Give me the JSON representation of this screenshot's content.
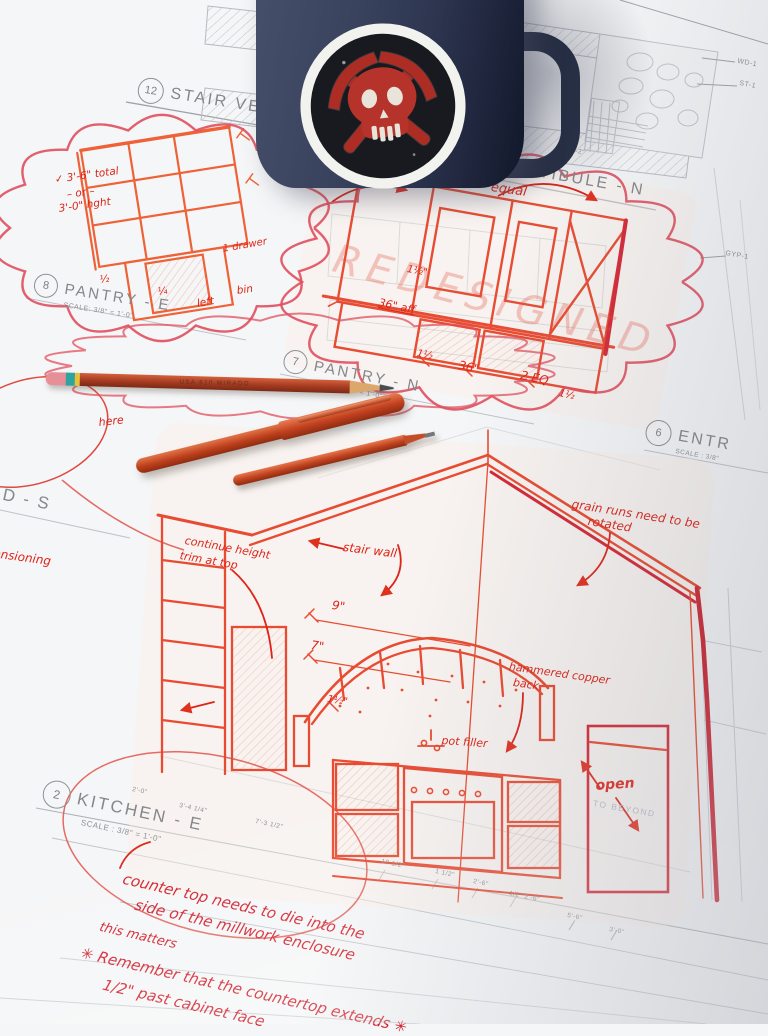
{
  "titles": {
    "v12": {
      "n": "12",
      "t": "STAIR VESTIBULE"
    },
    "v11": {
      "n": "11",
      "t": "STAIR VESTIBULE - N",
      "s": "SCALE:  3/8\" = 1'-0\""
    },
    "p8": {
      "n": "8",
      "t": "PANTRY - E",
      "s": "SCALE:  3/8\" = 1'-0\""
    },
    "p7": {
      "n": "7",
      "t": "PANTRY - N",
      "s": "SCALE:  3/8\" = 1'-0\""
    },
    "e6": {
      "n": "6",
      "t": "ENTR",
      "s": "SCALE : 3/8\""
    },
    "k2": {
      "n": "2",
      "t": "KITCHEN - E",
      "s": "SCALE : 3/8\" = 1'-0\""
    },
    "ds": {
      "t": "D - S"
    }
  },
  "plabels": {
    "wd1": "WD-1",
    "st1": "ST-1",
    "gyp1": "GYP-1",
    "beyond": "TO BEYOND",
    "d142": "14'-2\"",
    "dims": {
      "a": "2'-0\"",
      "b": "3'-4 1/4\"",
      "c": "7'-3 1/2\"",
      "d": "10 1/2\"",
      "e": "1 1/2\"",
      "f": "2'-6\"",
      "g": "1/2\" 2'-6\"",
      "h": "5'-6\"",
      "i": "3'-0\""
    }
  },
  "notes": {
    "equal": "equal",
    "redesigned": "REDESIGNED",
    "total": "✓ 3'-6\" total",
    "or": "– or –",
    "hght": "3'-0\" hght",
    "drawer": "1 drawer",
    "left": "left",
    "bin": "bin",
    "half": "½",
    "quarter": "¼",
    "n15a": "1½\"",
    "aff": "36\" aff",
    "n15b": "1½",
    "n36": "36\"",
    "n2eq": "2 EQ",
    "n15c": "1½",
    "trim1": "continue height",
    "trim2": "trim at top",
    "stair": "stair wall",
    "grain1": "grain runs need to be",
    "grain2": "rotated",
    "d9": "9\"",
    "d7": "7\"",
    "d15": "1½\"",
    "cop1": "hammered copper",
    "cop2": "back",
    "pot": "pot filler",
    "open": "open",
    "here": "here",
    "dimen": "dimensioning",
    "c1": "counter top needs to die into the",
    "c2": "side of the millwork enclosure",
    "c3": "this matters",
    "c4": "✳ Remember that the countertop extends ✳",
    "c5": "1/2\" past cabinet face"
  },
  "pencil": {
    "imprint": "USA 610 MIRADO"
  },
  "colors": {
    "sketch_red": "#e8452a",
    "marker_crimson": "#d21f2b",
    "cloud_red": "#e04f5e",
    "print_gray": "#84888d",
    "mug_navy": "#333b52",
    "sticker_skull_red": "#b5332a",
    "pen_orange": "#bd3f1c",
    "paper": "#f5f6f7"
  }
}
